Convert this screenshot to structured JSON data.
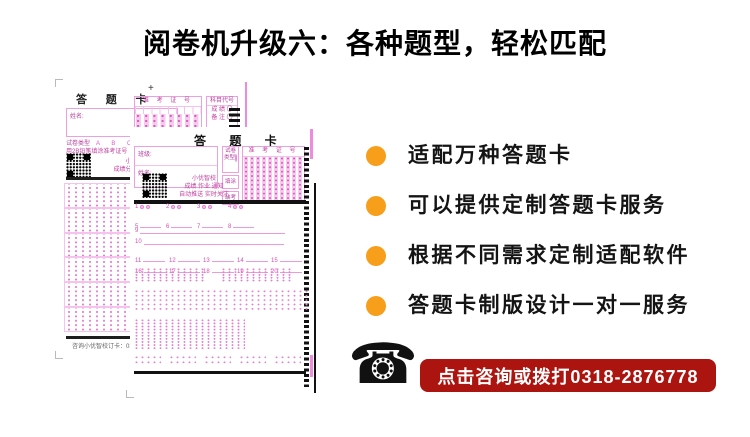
{
  "title": "阅卷机升级六：各种题型，轻松匹配",
  "colors": {
    "accent_orange": "#F79E1B",
    "banner_red": "#AC1410",
    "sheet_pink": "#E860CC"
  },
  "bullets": {
    "items": [
      {
        "label": "适配万种答题卡"
      },
      {
        "label": "可以提供定制答题卡服务"
      },
      {
        "label": "根据不同需求定制适配软件"
      },
      {
        "label": "答题卡制版设计一对一服务"
      }
    ]
  },
  "contact": {
    "phone_icon": "☎",
    "banner_label": "点击咨询或拨打0318-2876778"
  },
  "card_back": {
    "title": "答 题 卡",
    "plus_mark": "+",
    "name_label": "姓名:",
    "exam_no_label": "准 考 证 号",
    "subject_code_label": "科目代号",
    "subject_row1": "成 绩 〇",
    "subject_row2": "备 注 〇",
    "paper_type_label": "试卷类型",
    "paper_type_options": "A B C D",
    "pencil_note": "用2B铅笔填涂准考证号",
    "qr_line1": "小优智校",
    "qr_line2": "成绩分析自动推送",
    "footer_note": "咨询小优智校订卡：0318-287"
  },
  "card_front": {
    "title": "答 题 卡",
    "class_label": "班级:",
    "name_label": "姓名:",
    "paper_type_label": "试卷类型",
    "mark_box_label": "填涂",
    "absent_box_label": "缺考",
    "exam_no_label": "准 考 证 号",
    "qr_line1": "小优智校",
    "qr_line2": "成绩 作业 通知",
    "qr_line3": "自动推送 实时关注",
    "tf_numbers": [
      "1",
      "2",
      "3",
      "4"
    ],
    "blank_numbers": [
      "5",
      "6",
      "7",
      "8"
    ],
    "line_numbers": [
      "9",
      "10"
    ],
    "short_numbers": [
      "11",
      "12",
      "13",
      "14",
      "15",
      "16",
      "17",
      "18",
      "19",
      "20"
    ]
  }
}
